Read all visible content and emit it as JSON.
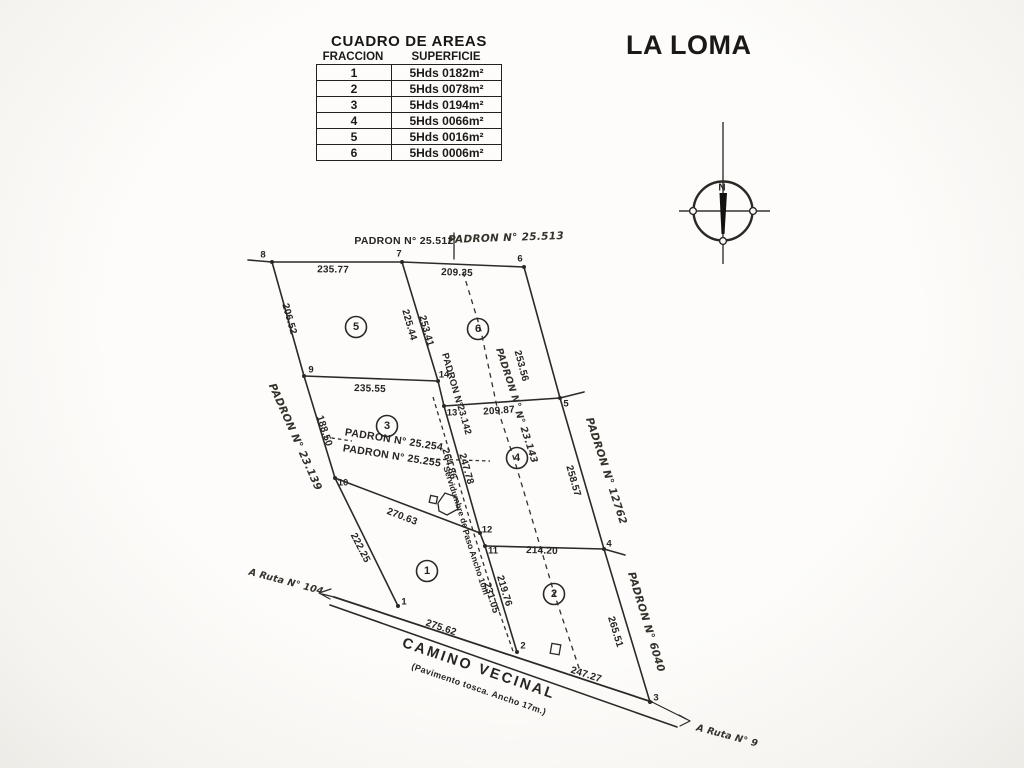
{
  "title": "LA LOMA",
  "areas_table": {
    "title": "CUADRO DE AREAS",
    "columns": [
      "FRACCION",
      "SUPERFICIE"
    ],
    "rows": [
      {
        "fraccion": "1",
        "superficie": "5Hds 0182m²"
      },
      {
        "fraccion": "2",
        "superficie": "5Hds 0078m²"
      },
      {
        "fraccion": "3",
        "superficie": "5Hds 0194m²"
      },
      {
        "fraccion": "4",
        "superficie": "5Hds 0066m²"
      },
      {
        "fraccion": "5",
        "superficie": "5Hds 0016m²"
      },
      {
        "fraccion": "6",
        "superficie": "5Hds 0006m²"
      }
    ]
  },
  "compass": {
    "north": "N"
  },
  "plan": {
    "fractions": {
      "f1": "1",
      "f2": "2",
      "f3": "3",
      "f4": "4",
      "f5": "5",
      "f6": "6"
    },
    "vertices": {
      "v1": "1",
      "v2": "2",
      "v3": "3",
      "v4": "4",
      "v5": "5",
      "v6": "6",
      "v7": "7",
      "v8": "8",
      "v9": "9",
      "v10": "10",
      "v11": "11",
      "v12": "12",
      "v13": "13",
      "v14": "14"
    },
    "measurements": {
      "seg_8_7": "235.77",
      "seg_7_6": "209.35",
      "seg_8_9": "206.52",
      "seg_7_14_west": "225.44",
      "seg_7_14": "253.41",
      "seg_6_5": "253.56",
      "seg_9_14": "235.55",
      "seg_13_5": "209.87",
      "seg_9_10": "188.50",
      "easement_mid": "264.86",
      "seg_13_12": "247.78",
      "seg_10_12": "270.63",
      "seg_10_1": "222.25",
      "seg_11_4": "214.20",
      "seg_5_4": "258.57",
      "easement_south": "231.05",
      "seg_11_2": "219.76",
      "seg_4_3": "265.51",
      "road_1_2": "275.62",
      "road_2_3": "247.27"
    },
    "padrones": {
      "top_west": "PADRON N° 25.512",
      "top_east": "PADRON N° 25.513",
      "west": "PADRON N° 23.139",
      "center_west_1": "PADRON N°",
      "center_west_2": "23.142",
      "center_east_1": "PADRON N°",
      "center_east_2": "N° 23.143",
      "interior_1": "PADRON N° 25.254",
      "interior_2": "PADRON N° 25.255",
      "east": "PADRON N° 12762",
      "southeast": "PADRON N° 6040"
    },
    "easement": {
      "line1": "Servidumbre de",
      "line2": "Paso Ancho 10m"
    },
    "road": {
      "name": "CAMINO VECINAL",
      "detail": "(Pavimento tosca. Ancho 17m.)",
      "to_route_west": "A Ruta N° 104",
      "to_route_east": "A Ruta N° 9"
    }
  }
}
